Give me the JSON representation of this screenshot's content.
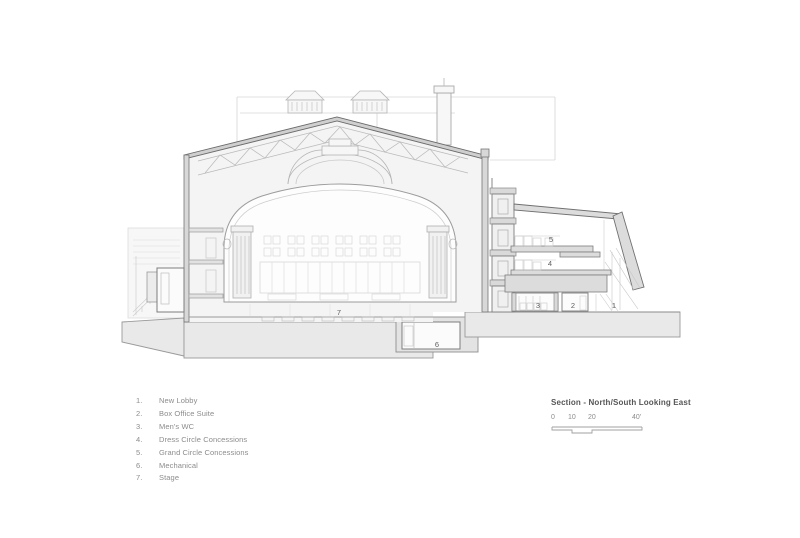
{
  "drawing": {
    "description": "Architectural building section of a historic theater, north/south cut looking east",
    "room_labels": [
      "1",
      "2",
      "3",
      "4",
      "5",
      "6",
      "7"
    ]
  },
  "legend": {
    "items": [
      {
        "num": "1.",
        "label": "New Lobby"
      },
      {
        "num": "2.",
        "label": "Box Office Suite"
      },
      {
        "num": "3.",
        "label": "Men's WC"
      },
      {
        "num": "4.",
        "label": "Dress Circle Concessions"
      },
      {
        "num": "5.",
        "label": "Grand Circle Concessions"
      },
      {
        "num": "6.",
        "label": "Mechanical"
      },
      {
        "num": "7.",
        "label": "Stage"
      }
    ]
  },
  "title_block": {
    "title": "Section - North/South Looking East",
    "scale_labels": [
      "0",
      "10",
      "20",
      "40'"
    ]
  },
  "colors": {
    "line_dark": "#6b6b6b",
    "line_mid": "#9a9a9a",
    "line_light": "#cdcdcd",
    "fill_building": "#f4f4f4",
    "fill_cut": "#dcdcdc",
    "fill_ground": "#e9e9e9",
    "legend_text": "#8c8c8c",
    "title_text": "#565656"
  }
}
